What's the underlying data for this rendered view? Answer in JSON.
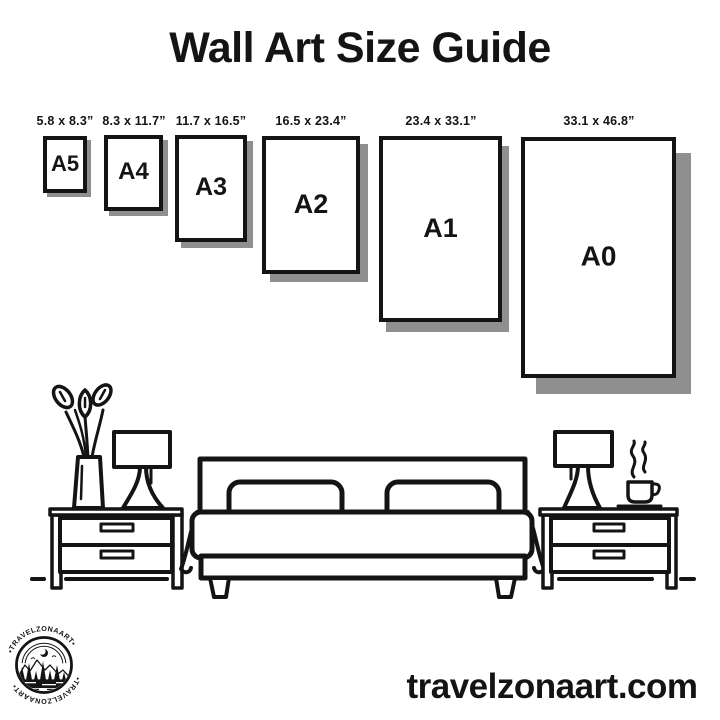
{
  "title": "Wall Art Size Guide",
  "sizes": [
    {
      "name": "A5",
      "dimensions": "5.8 x 8.3”"
    },
    {
      "name": "A4",
      "dimensions": "8.3 x 11.7”"
    },
    {
      "name": "A3",
      "dimensions": "11.7 x 16.5”"
    },
    {
      "name": "A2",
      "dimensions": "16.5 x 23.4”"
    },
    {
      "name": "A1",
      "dimensions": "23.4 x 33.1”"
    },
    {
      "name": "A0",
      "dimensions": "33.1 x 46.8”"
    }
  ],
  "logo": {
    "brand": "TRAVELZONAART",
    "arc_top": "•TRAVELZONAART•",
    "arc_bottom": "•TRAVELZONAART•"
  },
  "footer": {
    "website": "travelzonaart.com"
  },
  "colors": {
    "ink": "#141414",
    "shadow": "#8f8f8f",
    "background": "#ffffff"
  }
}
